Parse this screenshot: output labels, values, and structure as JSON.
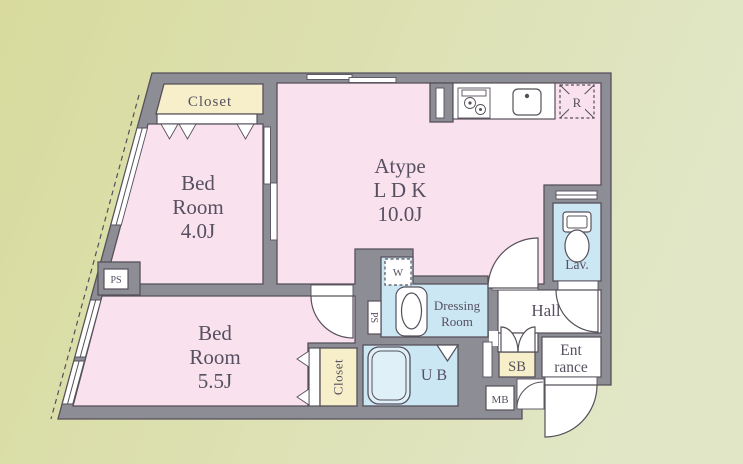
{
  "colors": {
    "background_left": "#d8db9d",
    "background_right": "#e1e6c6",
    "wall": "#8d8d95",
    "outline": "#56505a",
    "room_pink": "#f9e1ee",
    "closet_cream": "#f6efc9",
    "wet_blue": "#cbe7f3",
    "tub_fill": "#dff0f8",
    "floor_white": "#ffffff",
    "text": "#575060"
  },
  "rooms": {
    "ldk": {
      "line1": "Atype",
      "line2": "L D K",
      "line3": "10.0J"
    },
    "bedroom1": {
      "line1": "Bed",
      "line2": "Room",
      "line3": "4.0J"
    },
    "bedroom2": {
      "line1": "Bed",
      "line2": "Room",
      "line3": "5.5J"
    },
    "dressing": {
      "line1": "Dressing",
      "line2": "Room"
    },
    "hall": {
      "label": "Hall"
    },
    "lavatory": {
      "label": "Lav."
    },
    "unit_bath": {
      "label": "UB"
    },
    "entrance": {
      "line1": "Ent",
      "line2": "rance"
    },
    "closet_top": {
      "label": "Closet"
    },
    "closet_bottom": {
      "label": "Closet"
    }
  },
  "labels": {
    "shoe_box": "SB",
    "meter_box": "MB",
    "pipe_space_left": "PS",
    "pipe_space_mid": "PS",
    "washing_machine": "W",
    "refrigerator": "R"
  }
}
